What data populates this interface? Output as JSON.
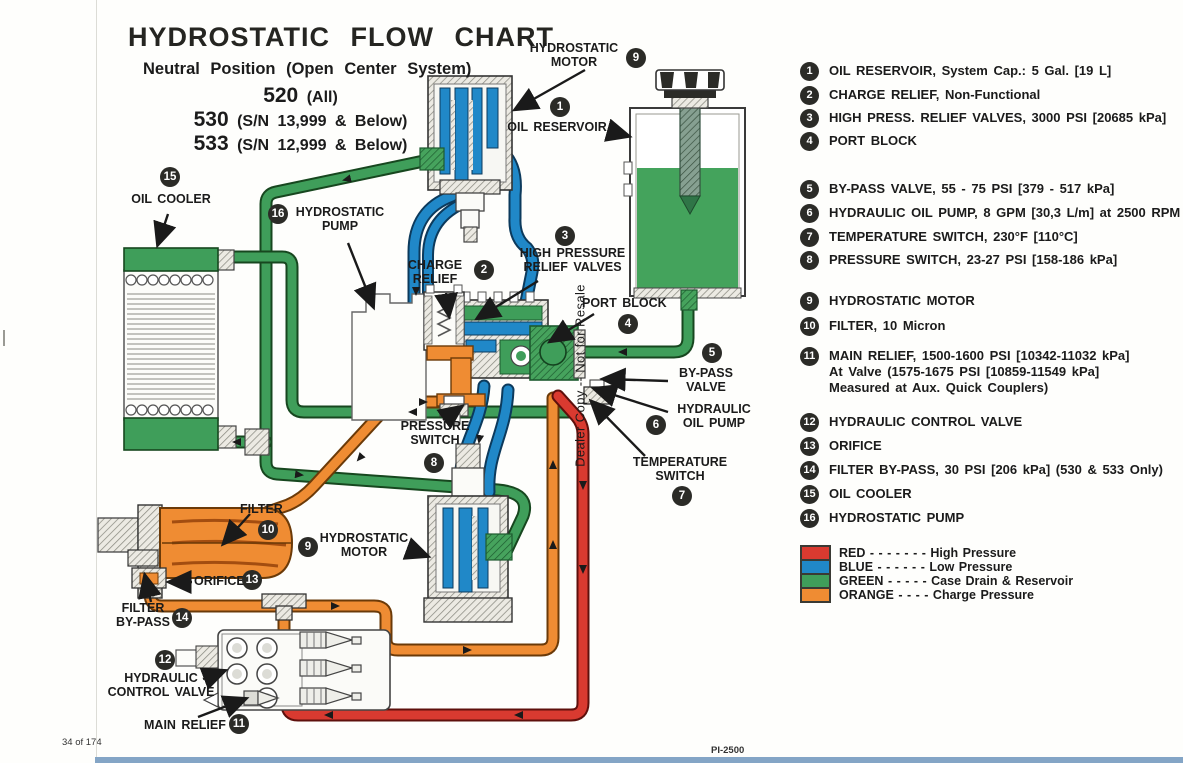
{
  "header": {
    "title": "HYDROSTATIC FLOW CHART",
    "subtitle": "Neutral Position (Open Center System)",
    "models": [
      {
        "num": "520",
        "rest": " (All)"
      },
      {
        "num": "530",
        "rest": " (S/N 13,999 & Below)"
      },
      {
        "num": "533",
        "rest": " (S/N 12,999 & Below)"
      }
    ]
  },
  "legend": {
    "items": [
      {
        "num": "1",
        "text": "OIL RESERVOIR, System Cap.:  5 Gal. [19 L]"
      },
      {
        "num": "2",
        "text": "CHARGE RELIEF, Non-Functional"
      },
      {
        "num": "3",
        "text": "HIGH PRESS. RELIEF VALVES, 3000 PSI [20685 kPa]"
      },
      {
        "num": "4",
        "text": "PORT BLOCK"
      },
      {
        "num": "5",
        "text": "BY-PASS VALVE, 55 - 75 PSI [379 - 517 kPa]"
      },
      {
        "num": "6",
        "text": "HYDRAULIC OIL PUMP, 8 GPM [30,3 L/m] at 2500 RPM"
      },
      {
        "num": "7",
        "text": "TEMPERATURE SWITCH, 230°F [110°C]"
      },
      {
        "num": "8",
        "text": "PRESSURE SWITCH, 23-27 PSI [158-186 kPa]"
      },
      {
        "num": "9",
        "text": "HYDROSTATIC MOTOR"
      },
      {
        "num": "10",
        "text": "FILTER, 10 Micron"
      },
      {
        "num": "11",
        "text": "MAIN RELIEF, 1500-1600 PSI [10342-11032 kPa]\nAt Valve (1575-1675 PSI [10859-11549 kPa]\nMeasured at Aux. Quick Couplers)"
      },
      {
        "num": "12",
        "text": "HYDRAULIC CONTROL VALVE"
      },
      {
        "num": "13",
        "text": "ORIFICE"
      },
      {
        "num": "14",
        "text": "FILTER BY-PASS, 30 PSI [206 kPa] (530 & 533 Only)"
      },
      {
        "num": "15",
        "text": "OIL COOLER"
      },
      {
        "num": "16",
        "text": "HYDROSTATIC PUMP"
      }
    ]
  },
  "color_key": {
    "rows": [
      {
        "name": "RED",
        "dashes": "- - - - - - -",
        "desc": "High Pressure",
        "color": "#d93a30"
      },
      {
        "name": "BLUE",
        "dashes": "- - - - - -",
        "desc": "Low Pressure",
        "color": "#2088c8"
      },
      {
        "name": "GREEN",
        "dashes": "- - - - -",
        "desc": "Case Drain & Reservoir",
        "color": "#3f9e5a"
      },
      {
        "name": "ORANGE",
        "dashes": "- - - -",
        "desc": "Charge Pressure",
        "color": "#ef8c33"
      }
    ]
  },
  "diagram_labels": {
    "motor_top": {
      "badge": "9",
      "text": "HYDROSTATIC\nMOTOR"
    },
    "reservoir": {
      "badge": "1",
      "text": "OIL RESERVOIR"
    },
    "cooler": {
      "badge": "15",
      "text": "OIL COOLER"
    },
    "pump": {
      "badge": "16",
      "text": "HYDROSTATIC\nPUMP"
    },
    "charge_relief": {
      "badge": "2",
      "text": "CHARGE\nRELIEF"
    },
    "hprv": {
      "badge": "3",
      "text": "HIGH PRESSURE\nRELIEF VALVES"
    },
    "port_block": {
      "badge": "4",
      "text": "PORT BLOCK"
    },
    "bypass": {
      "badge": "5",
      "text": "BY-PASS\nVALVE"
    },
    "oil_pump": {
      "badge": "6",
      "text": "HYDRAULIC\nOIL PUMP"
    },
    "temp_switch": {
      "badge": "7",
      "text": "TEMPERATURE\nSWITCH"
    },
    "pressure_switch": {
      "badge": "8",
      "text": "PRESSURE\nSWITCH"
    },
    "filter": {
      "badge": "10",
      "text": "FILTER"
    },
    "motor_bottom": {
      "badge": "9",
      "text": "HYDROSTATIC\nMOTOR"
    },
    "orifice": {
      "badge": "13",
      "text": "ORIFICE"
    },
    "filter_bypass": {
      "badge": "14",
      "text": "FILTER\nBY-PASS"
    },
    "hcv": {
      "badge": "12",
      "text": "HYDRAULIC\nCONTROL VALVE"
    },
    "main_relief": {
      "badge": "11",
      "text": "MAIN RELIEF"
    }
  },
  "page": {
    "watermark": "Dealer Copy -- Not for Resale",
    "footer_left": "34 of 174",
    "footer_right": "PI-2500"
  },
  "colors": {
    "red": "#d93a30",
    "blue": "#2088c8",
    "green": "#3f9e5a",
    "orange": "#ef8c33"
  }
}
